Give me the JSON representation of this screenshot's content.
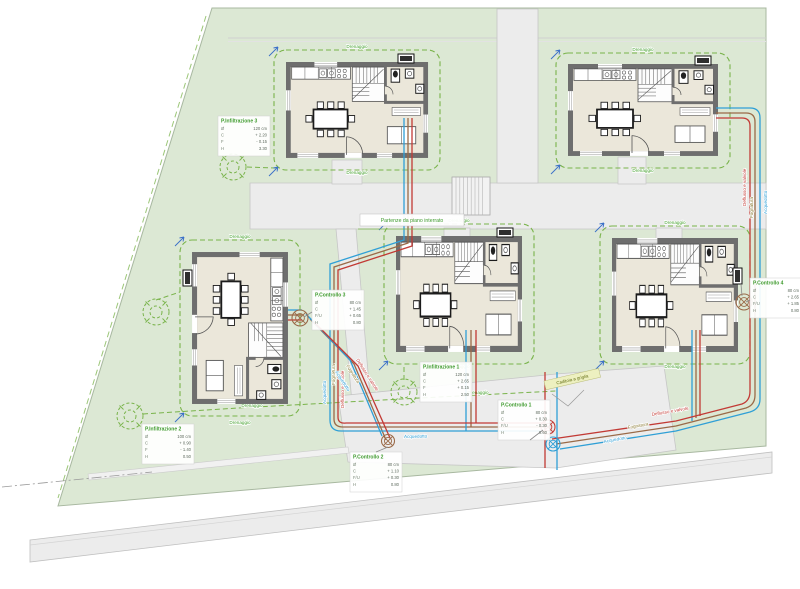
{
  "plan": {
    "name": "Planimetria impianti - lottizzazione 5 unità",
    "pipe_labels": {
      "water": "Acquedotto",
      "sewer": "Fognatura",
      "valves": "Deflusso e valvole",
      "drain": "Drenaggio"
    },
    "notes": {
      "basement": "Partenze da piano interrato",
      "street_drain": "Caditoia a griglia"
    },
    "info_boxes": [
      {
        "id": "pi1",
        "title": "P.Infiltrazione 1",
        "rows": [
          [
            "Ø",
            "120 cm"
          ],
          [
            "C",
            "+ 2.65"
          ],
          [
            "F",
            "+ 0.15"
          ],
          [
            "H",
            "2.50"
          ]
        ]
      },
      {
        "id": "pi2",
        "title": "P.Infiltrazione 2",
        "rows": [
          [
            "Ø",
            "100 cm"
          ],
          [
            "C",
            "+ 0.90"
          ],
          [
            "F",
            "- 1.40"
          ],
          [
            "H",
            "0.50"
          ]
        ]
      },
      {
        "id": "pi3",
        "title": "P.Infiltrazione 3",
        "rows": [
          [
            "Ø",
            "120 cm"
          ],
          [
            "C",
            "+ 2.20"
          ],
          [
            "F",
            "- 0.15"
          ],
          [
            "H",
            "3.30"
          ]
        ]
      },
      {
        "id": "pc1",
        "title": "P.Controllo 1",
        "rows": [
          [
            "Ø",
            "80 cm"
          ],
          [
            "C",
            "+ 0.30"
          ],
          [
            "F/U",
            "- 0.30"
          ],
          [
            "H",
            "0.60"
          ]
        ]
      },
      {
        "id": "pc2",
        "title": "P.Controllo 2",
        "rows": [
          [
            "Ø",
            "80 cm"
          ],
          [
            "C",
            "+ 1.10"
          ],
          [
            "F/U",
            "+ 0.30"
          ],
          [
            "H",
            "0.80"
          ]
        ]
      },
      {
        "id": "pc3",
        "title": "P.Controllo 3",
        "rows": [
          [
            "Ø",
            "80 cm"
          ],
          [
            "C",
            "+ 1.45"
          ],
          [
            "F/U",
            "+ 0.65"
          ],
          [
            "H",
            "0.80"
          ]
        ]
      },
      {
        "id": "pc4",
        "title": "P.Controllo 4",
        "rows": [
          [
            "Ø",
            "80 cm"
          ],
          [
            "C",
            "+ 2.65"
          ],
          [
            "F/U",
            "+ 1.85"
          ],
          [
            "H",
            "0.80"
          ]
        ]
      }
    ],
    "colors": {
      "parcelFill": "#dce8d4",
      "parcelStroke": "#a8b8a0",
      "road": "#ececec",
      "roadStroke": "#c6c6c6",
      "floor": "#ebe7da",
      "wall": "#6e6e6e",
      "water": "#2f9fd6",
      "sewer": "#9a6a48",
      "valves": "#c23a35",
      "drain": "#79b34a",
      "drainText": "#43a02c",
      "boxTitle": "#3f9b2e",
      "rowKey": "#7a8877",
      "rowVal": "#5f6b5f",
      "leader": "#8a8a8a",
      "caditoiaBg": "#edf0c0",
      "caditoiaText": "#626d12",
      "meter": "#2e2e2e",
      "cornerMark": "#3a6fc8",
      "fixture": "#1c1c1c",
      "fixtureLight": "#555555"
    }
  }
}
